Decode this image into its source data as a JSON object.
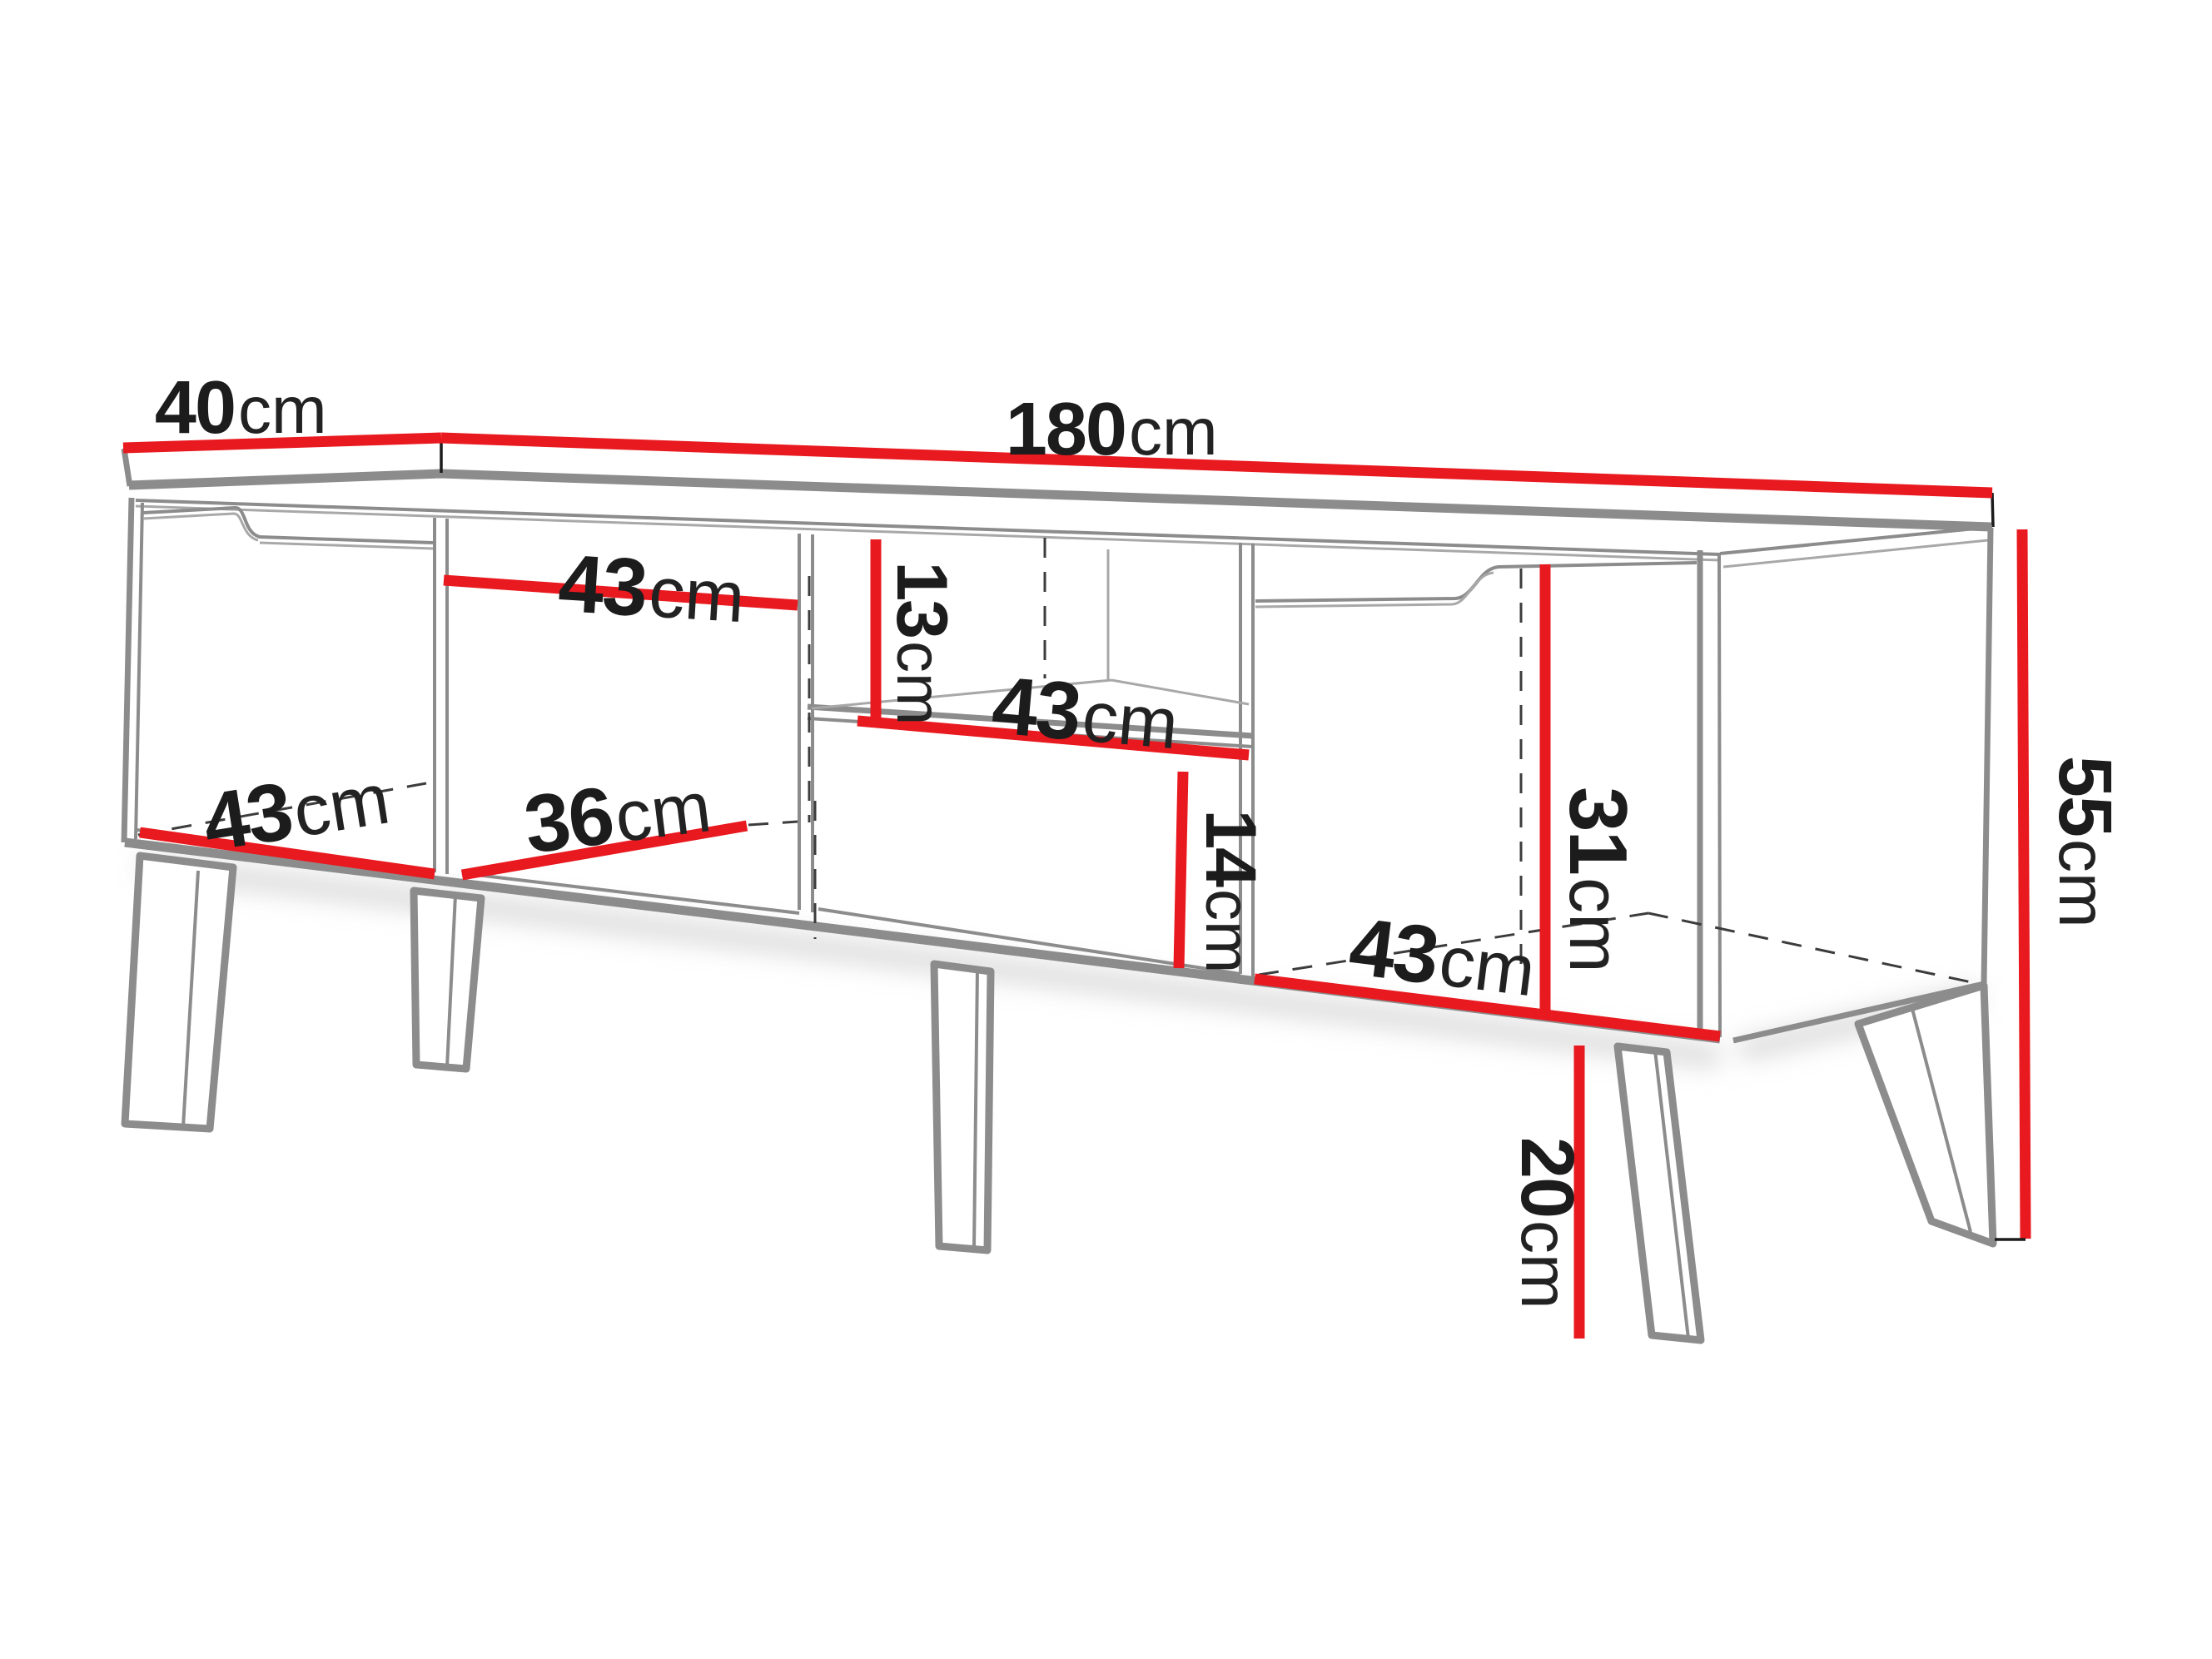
{
  "diagram": {
    "type": "furniture-dimension-drawing",
    "subject": "TV stand / media cabinet perspective line drawing with measurements",
    "units": "cm",
    "colors": {
      "dimension_red": "#e8191f",
      "outline_gray": "#8c8c8c",
      "outline_gray_light": "#a8a8a8",
      "text_black": "#1c1c1c"
    },
    "dimensions": {
      "top_depth": {
        "value": "40",
        "unit": "cm"
      },
      "top_width": {
        "value": "180",
        "unit": "cm"
      },
      "left_opening_width": {
        "value": "43",
        "unit": "cm"
      },
      "upper_niche_height": {
        "value": "13",
        "unit": "cm"
      },
      "middle_shelf_width": {
        "value": "43",
        "unit": "cm"
      },
      "left_compartment_depth": {
        "value": "43",
        "unit": "cm"
      },
      "middle_compartment_depth": {
        "value": "36",
        "unit": "cm"
      },
      "lower_niche_height": {
        "value": "14",
        "unit": "cm"
      },
      "right_compartment_height": {
        "value": "31",
        "unit": "cm"
      },
      "right_compartment_width": {
        "value": "43",
        "unit": "cm"
      },
      "body_height": {
        "value": "55",
        "unit": "cm"
      },
      "leg_height": {
        "value": "20",
        "unit": "cm"
      }
    }
  }
}
